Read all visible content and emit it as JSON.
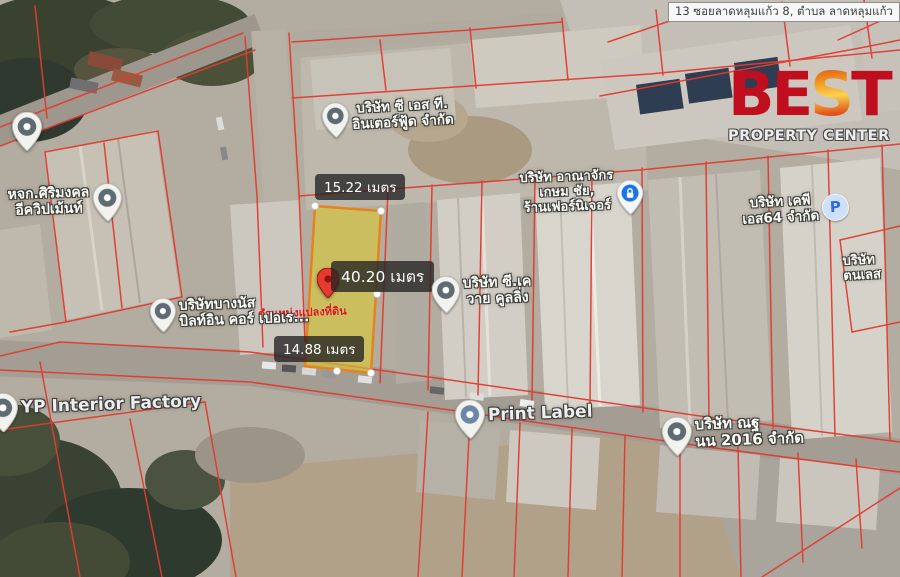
{
  "address_bar": {
    "text": "13 ซอยลาดหลุมแก้ว 8, ตำบล ลาดหลุมแก้ว"
  },
  "logo": {
    "part_be": "BE",
    "part_s": "S",
    "part_t": "T",
    "subtitle": "PROPERTY CENTER",
    "brand_red": "#bf0e1d",
    "flame_orange": "#f08f1e"
  },
  "plot": {
    "top_width": "15.22 เมตร",
    "length": "40.20 เมตร",
    "bottom_width": "14.88 เมตร",
    "position_caption": "ตำแหน่งแปลงที่ดิน",
    "fill_color": "#d9ca35",
    "border_color": "#e8821e",
    "pin_color": "#e63a2e"
  },
  "boundary_lines_color": "#e23b30",
  "place_labels": {
    "cst": {
      "line1": "บริษัท ซี เอส ที.",
      "line2": "อินเตอร์ฟู้ด จำกัด"
    },
    "sirimongkol": {
      "line1": "หจก.ศิริมงคล",
      "line2": "อีควิปเม้นท์"
    },
    "anajak": {
      "line1": "บริษัท อาณาจักร",
      "line2": "เกษม ชัย,",
      "line3": "ร้านเฟอร์นิเจอร์"
    },
    "kp": {
      "line1": "บริษัท เคพี",
      "line2": "เอส64 จำกัด"
    },
    "tonles": {
      "line1": "บริษัท",
      "line2": "ตนเลส"
    },
    "ck": {
      "line1": "บริษัท ซี.เค",
      "line2": "วาย คูลลิ่ง"
    },
    "bangnas": {
      "line1": "บริษัทบางนัส",
      "line2": "บิลท์อิน คอร์ เปอเร..."
    },
    "yp": {
      "line1": "YP Interior Factory"
    },
    "print_label": {
      "line1": "Print Label"
    },
    "nt2016": {
      "line1": "บริษัท ณฐ",
      "line2": "นน 2016 จำกัด"
    },
    "parking_letter": "P"
  }
}
